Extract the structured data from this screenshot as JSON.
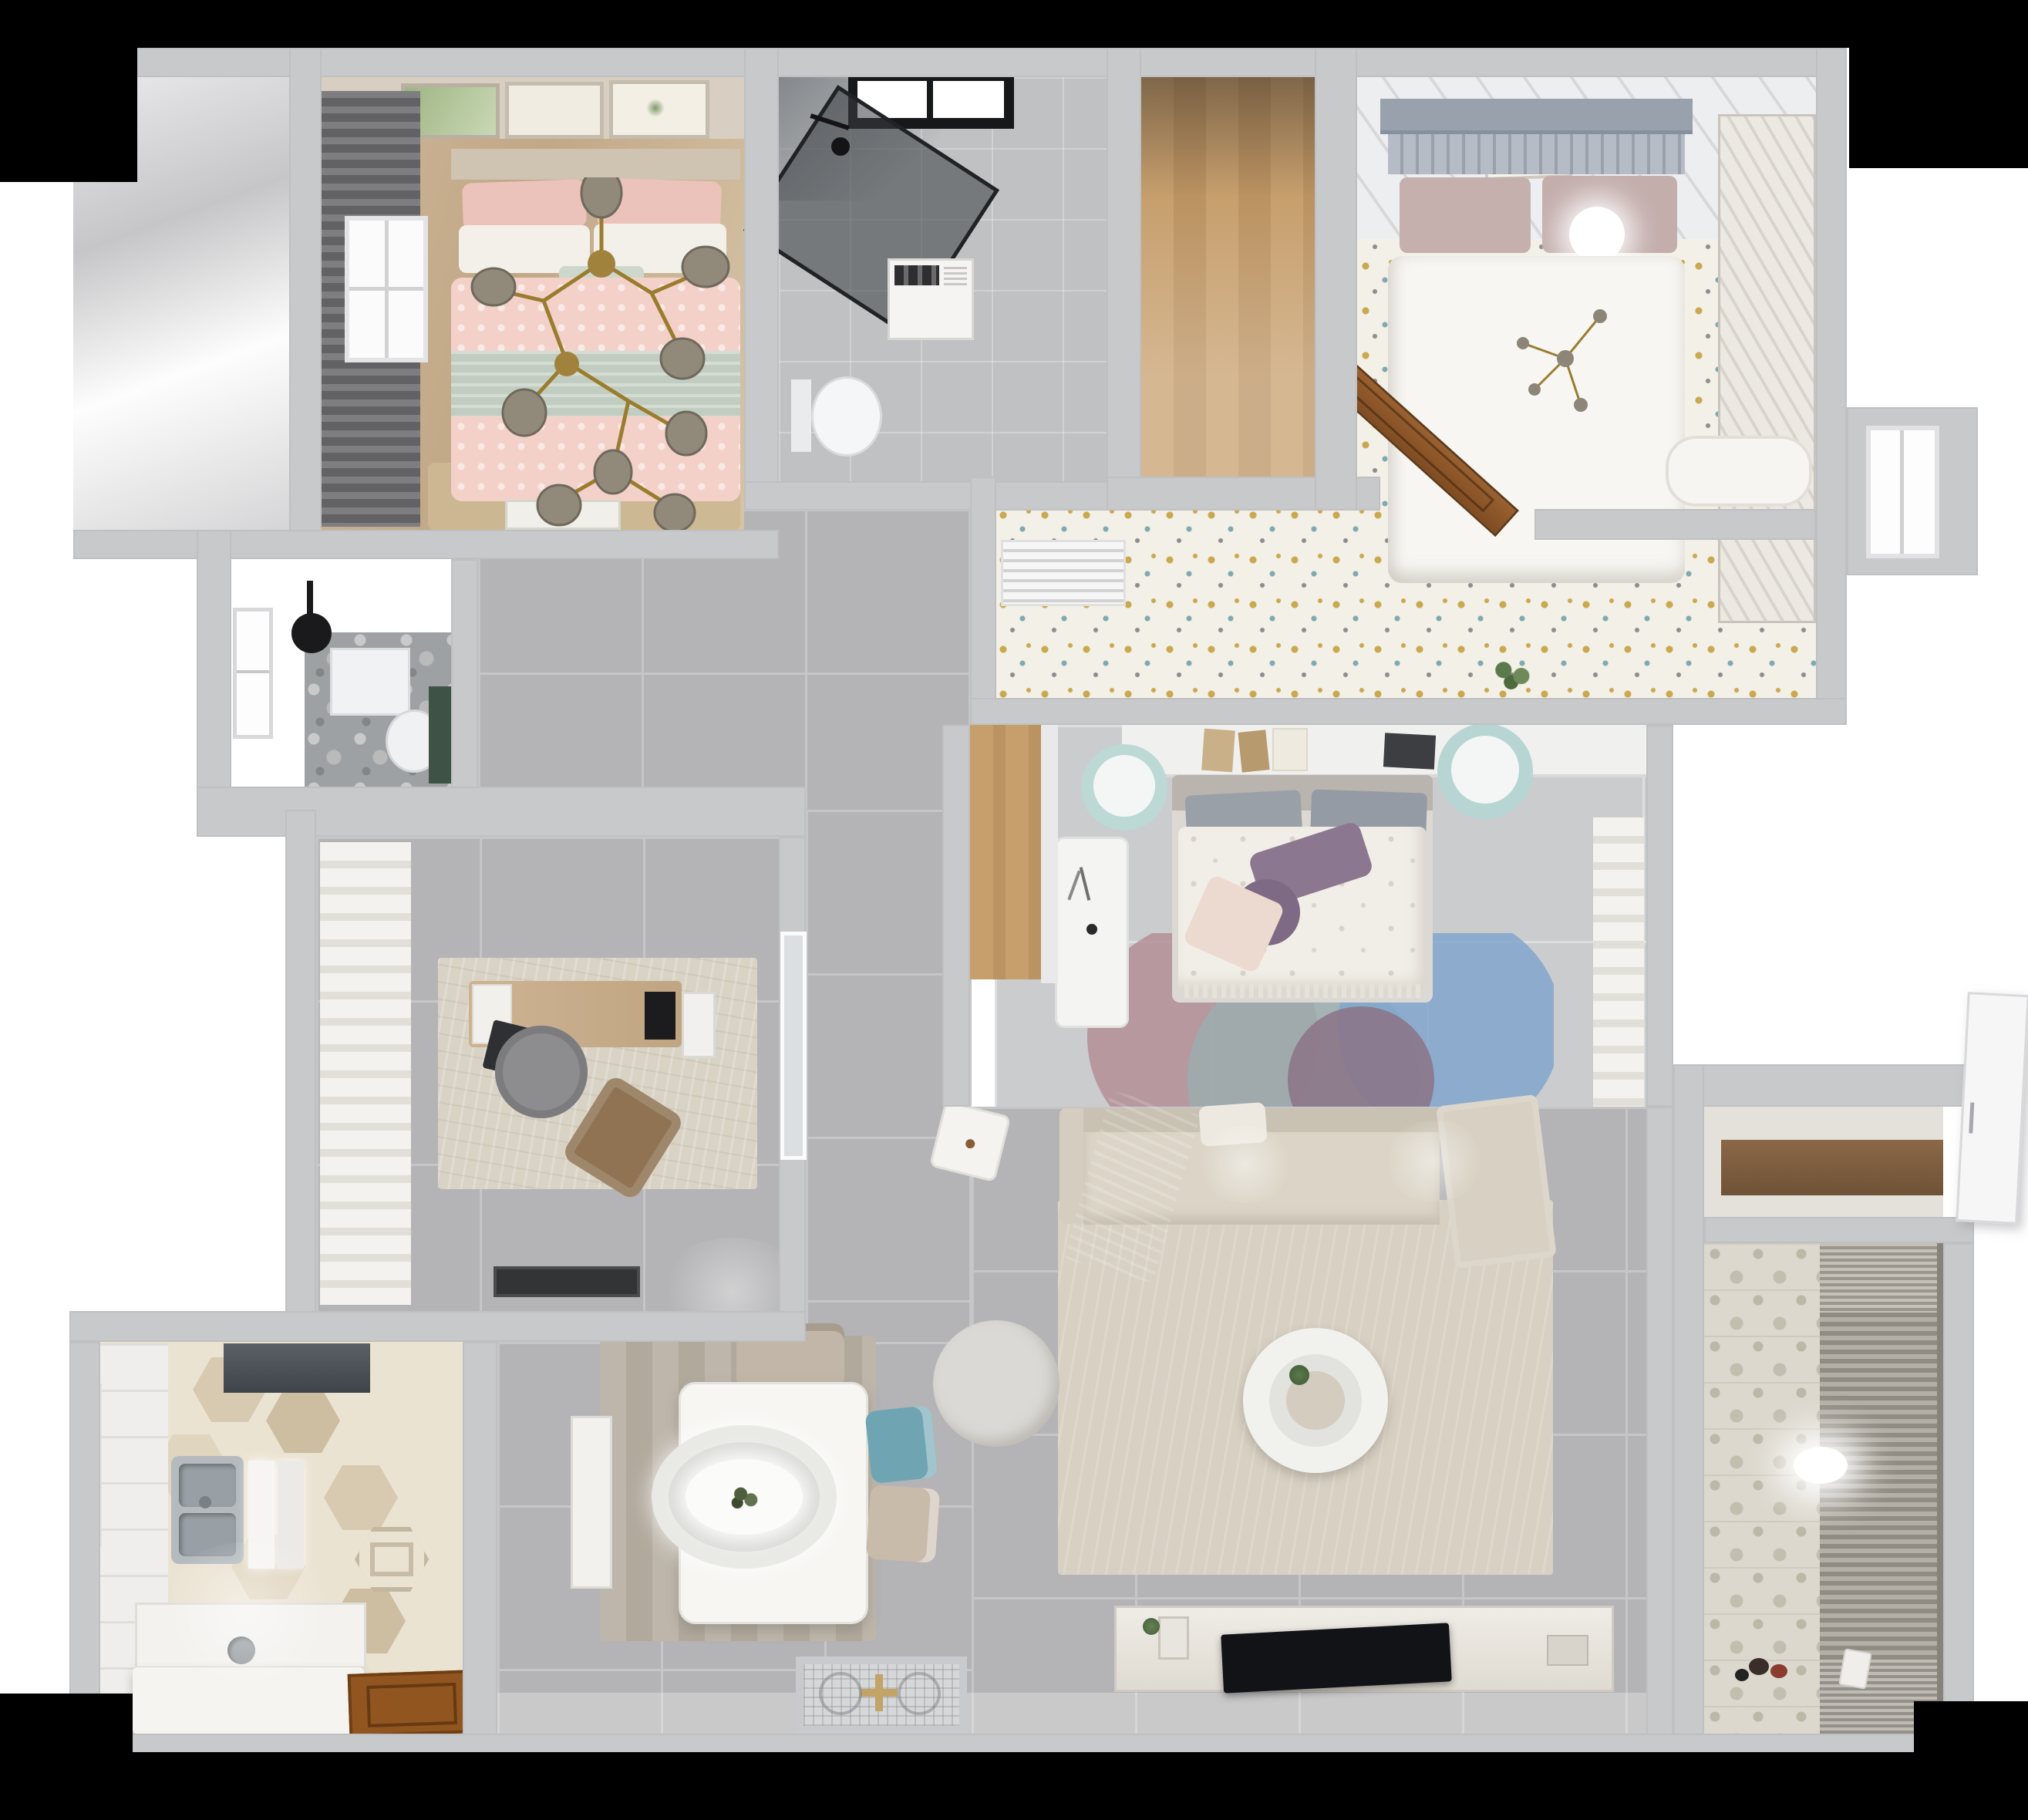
{
  "meta": {
    "title": "Top-down 3D apartment floor plan render",
    "view": "bird's-eye cutaway",
    "text_visible": "none"
  },
  "palette": {
    "black": "#000000",
    "white": "#ffffff",
    "wall": "#c8c9cb",
    "wall_edge": "#bfc0c2",
    "wall_inner": "#e9e9eb",
    "hall_tile": "#b4b4b6",
    "hall_grout": "#c6c6c8",
    "room_tile": "#cbccce",
    "wood_floor_a": "#cdb697",
    "wood_floor_b": "#c1a887",
    "wood_floor_c": "#d6c3a6",
    "wood_plank": "#c79f6d",
    "wood_dark": "#bb9261",
    "door_wood": "#91551f",
    "door_wood_dark": "#6f3f14",
    "curtain_dark_a": "#7e7e80",
    "curtain_dark_b": "#626264",
    "curtain_light": "#f4f2ee",
    "curtain_fold": "#e2dfd8",
    "pink": "#f3d1c9",
    "pink_deep": "#ecc3ba",
    "sage": "#c2cdc1",
    "linen": "#f3f0ea",
    "gold": "#a0823c",
    "bulb": "#91897a",
    "headboard": "#99a1ad",
    "slat": "#b6bcc6",
    "mauve": "#c5b0ae",
    "speckle_base": "#f3f0e8",
    "speck_gold": "#c9a84f",
    "speck_teal": "#7fa9b0",
    "speck_gray": "#8d8d8d",
    "wardrobe": "#ece9e3",
    "wardrobe_slat": "#d8d4cb",
    "bath_floor": "#bfc1c3",
    "bath_dark": "#85888c",
    "glass_dark": "rgba(58,62,66,0.55)",
    "fixture_black": "#141416",
    "green_accent": "#3f5246",
    "office_rug": "#d9d3c6",
    "desk_wood_a": "#cdb392",
    "desk_wood_b": "#c0a582",
    "chair_gray": "#8d8d8f",
    "lounge_brown": "#8f7352",
    "mat_dark": "#333436",
    "kitchen_floor": "#ebe3d2",
    "hex_a": "#d8cab1",
    "hex_b": "#cdbda1",
    "hex_c": "#e0d5bf",
    "counter": "#f3f2ef",
    "steel": "#b4babe",
    "steel_deep": "#98a0a5",
    "hood_a": "#5a6066",
    "hood_b": "#3f444a",
    "dining_rug_a": "#beb6ab",
    "dining_rug_b": "#b2a99d",
    "table_white": "#f7f6f3",
    "chair_teal": "#6fa5b2",
    "chair_beige": "#c9bbaa",
    "pendant": "#e9e9e6",
    "living_rug": "#d8d0c2",
    "sofa": "#dcd5c7",
    "sofa_back": "#c9c2b3",
    "throw_a": "#585d63",
    "throw_b": "#454a50",
    "tv_black": "#121316",
    "console_a": "#efece6",
    "console_b": "#dfdbd2",
    "balcony_wall": "#dcd8ce",
    "balcony_floor": "#d6d4cf",
    "blind_a": "#b3afa6",
    "blind_b": "#908c83",
    "rug_rose": "rgba(177,140,148,0.82)",
    "rug_blue": "rgba(127,165,205,0.82)",
    "rug_teal": "rgba(155,175,176,0.82)",
    "rug_purple": "rgba(139,115,134,0.85)",
    "entry_mat": "#d6d7d9",
    "mat_gold": "#c2a368",
    "shelf_white": "#f0f0ee",
    "storage_counter_a": "#8a6847",
    "storage_counter_b": "#6f5236"
  },
  "rooms": {
    "master_bedroom": {
      "name": "Master bedroom with pink bedding",
      "furniture": [
        "double bed",
        "pink duvet",
        "sage blanket",
        "branch chandelier",
        "three wall frames",
        "dark curtains",
        "window",
        "white door",
        "dresser",
        "tan rug"
      ]
    },
    "bathroom_top": {
      "name": "Shower bathroom",
      "furniture": [
        "black framed window",
        "glass shower screen",
        "black shower fixture",
        "vanity",
        "toilet"
      ]
    },
    "entry_closet": {
      "name": "Wood floor closet room"
    },
    "bedroom_right": {
      "name": "Bedroom with gray headboard bed",
      "furniture": [
        "double bed",
        "ball lamp",
        "wall art",
        "louvered wardrobe",
        "white bench",
        "open wood door",
        "AC louver",
        "plant"
      ]
    },
    "window_niche": {
      "name": "Window niche"
    },
    "bathroom_left": {
      "name": "Dark tile bathroom",
      "furniture": [
        "window",
        "black shower head",
        "wall shelf",
        "toilet",
        "green vanity"
      ]
    },
    "office": {
      "name": "Home office",
      "furniture": [
        "white curtains",
        "rug",
        "wood desk",
        "papers",
        "laptop",
        "round desk chair",
        "brown lounge chair",
        "wall TV",
        "cabinet",
        "dark doormat",
        "glass door"
      ]
    },
    "bedroom_middle": {
      "name": "Bedroom with floral duvet",
      "furniture": [
        "wall shelf with books",
        "double bed",
        "purple pillows",
        "blush pillow",
        "round color-block rug",
        "white desk",
        "two teal stools",
        "wood nook",
        "white curtains"
      ]
    },
    "kitchen": {
      "name": "Kitchen with hex tile floor",
      "furniture": [
        "range hood",
        "double stainless sink",
        "cutting boards",
        "window",
        "counters",
        "island",
        "open wood door",
        "accent hex tiles"
      ]
    },
    "dining": {
      "name": "Dining area",
      "furniture": [
        "plank rug",
        "white table",
        "oval pendant lamp",
        "beige chair",
        "teal chair",
        "beige chair",
        "white console",
        "ornate entry mat"
      ]
    },
    "living": {
      "name": "Living room",
      "furniture": [
        "sectional sofa",
        "gray throw",
        "white pillow",
        "beige rug",
        "ring coffee table",
        "plant",
        "gray pouf",
        "white side stool",
        "TV console",
        "flat TV",
        "decor frames"
      ]
    },
    "storage": {
      "name": "Storage niche with wood counter"
    },
    "balcony": {
      "name": "Balcony laundry with blinds",
      "furniture": [
        "patterned tile wall",
        "roller blinds",
        "oval ceiling light",
        "toys",
        "watering can"
      ]
    },
    "hallway": {
      "name": "Tiled hallway"
    },
    "right_door": {
      "name": "White door at right wall"
    }
  }
}
